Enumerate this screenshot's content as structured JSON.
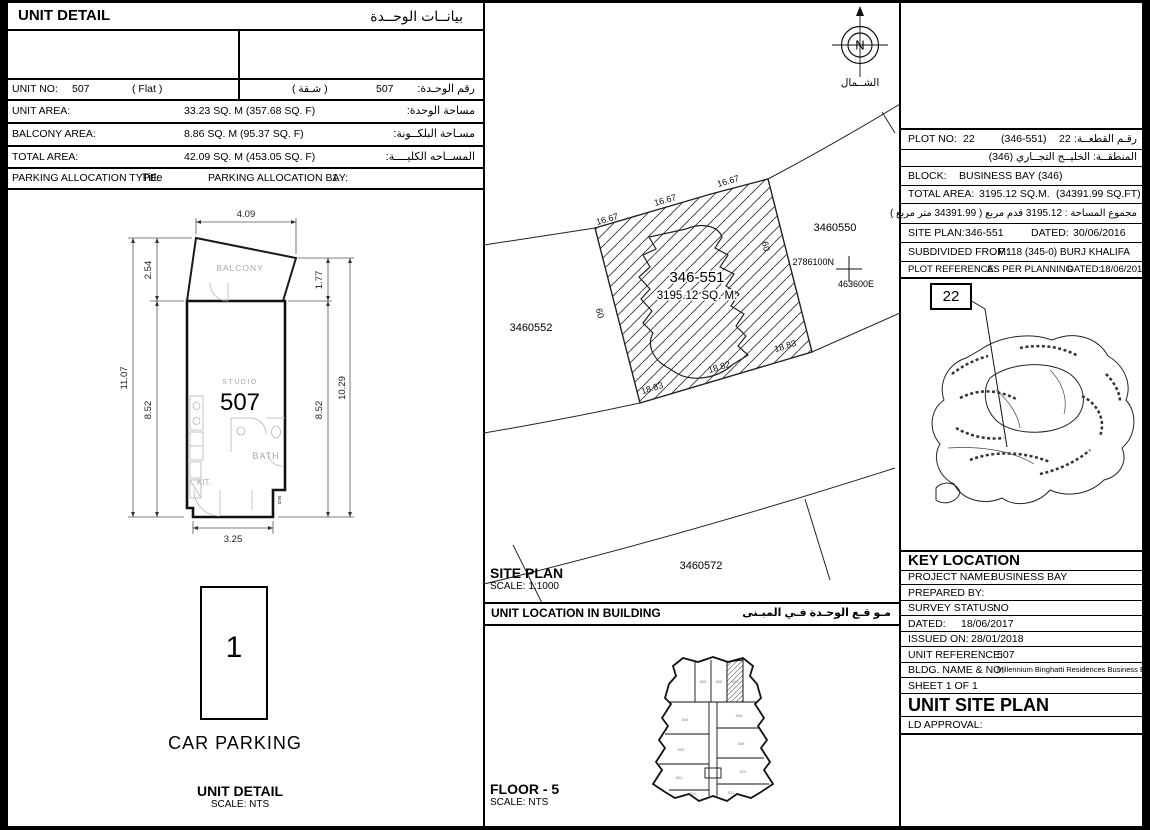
{
  "unit_detail": {
    "title_en": "UNIT DETAIL",
    "title_ar": "بيانــات الوحــدة",
    "unit_no": {
      "label": "UNIT NO:",
      "value": "507",
      "type_en": "(   Flat   )",
      "type_ar": "( شـقة )",
      "value_ar": "507",
      "label_ar": "رقم الوحـدة:"
    },
    "rows": [
      {
        "label": "UNIT AREA:",
        "value": "33.23 SQ. M (357.68 SQ. F)",
        "label_ar": "مساحة الوحدة:"
      },
      {
        "label": "BALCONY AREA:",
        "value": "8.86 SQ. M (95.37 SQ. F)",
        "label_ar": "مسـاحة البلكــونة:"
      },
      {
        "label": "TOTAL AREA:",
        "value": "42.09 SQ. M (453.05 SQ. F)",
        "label_ar": "المســاحه الكليــــة:"
      }
    ],
    "parking": {
      "type_label": "PARKING ALLOCATION TYPE:",
      "type_value": "Title",
      "bay_label": "PARKING ALLOCATION BAY:",
      "bay_value": "1"
    }
  },
  "floor_plan": {
    "dims": {
      "top": "4.09",
      "balcony_left": "2.54",
      "overall_left": "11.07",
      "unit_left": "8.52",
      "balcony_right": "1.77",
      "unit_right": "8.52",
      "overall_right": "10.29",
      "bottom": "3.25"
    },
    "labels": {
      "balcony": "BALCONY",
      "studio": "STUDIO",
      "unit_number": "507",
      "bath": "BATH",
      "kitchen": "KIT.",
      "md": "M.D"
    },
    "caption": "UNIT DETAIL",
    "caption_scale": "SCALE: NTS"
  },
  "car_parking": {
    "bay_number": "1",
    "label": "CAR PARKING"
  },
  "site_plan": {
    "north_letter": "N",
    "north_label_ar": "الشــمال",
    "plot_number": "346-551",
    "plot_area": "3195.12 SQ. M.",
    "dim_top": [
      "16.67",
      "16.67",
      "16.67"
    ],
    "dim_side_left": "60",
    "dim_side_right": "60",
    "dim_bottom": [
      "18.83",
      "18.82",
      "18.83"
    ],
    "parcels": [
      "3460550",
      "3460552",
      "3460572"
    ],
    "northing": "2786100N",
    "easting": "463600E",
    "caption": "SITE PLAN",
    "caption_scale": "SCALE: 1:1000"
  },
  "unit_location": {
    "title_en": "UNIT LOCATION IN BUILDING",
    "title_ar": "مـو قـع الوحـدة  فـي المبـنى",
    "units": {
      "top": [
        "505",
        "506",
        "507"
      ],
      "left": [
        "504",
        "503",
        "502",
        "501"
      ],
      "right": [
        "508",
        "509",
        "510",
        "511"
      ]
    },
    "caption": "FLOOR - 5",
    "caption_scale": "SCALE: NTS"
  },
  "plot_info": {
    "callout": "22",
    "plot_no_label": "PLOT NO:",
    "plot_no": "22",
    "plot_paren": "(346-551)",
    "plot_no_2": "22",
    "plot_label_ar": "رقـم القطعــة:",
    "district_ar": "المنطقــة: الخليــج التجــاري (346)",
    "block_label": "BLOCK:",
    "block": "BUSINESS BAY (346)",
    "total_area_label": "TOTAL AREA:",
    "total_area": "3195.12 SQ.M.",
    "total_area_ft": "(34391.99 SQ.FT)",
    "total_area_ar": "مجموع المساحة :  3195.12 قدم مربع  ( 34391.99 متر مربع )",
    "site_plan_label": "SITE PLAN:",
    "site_plan": "346-551",
    "dated_label": "DATED:",
    "dated": "30/06/2016",
    "subdivided_label": "SUBDIVIDED FROM:",
    "subdivided": "P.118 (345-0) BURJ KHALIFA",
    "plot_ref_label": "PLOT REFERENCE:",
    "plot_ref_value": "AS PER PLANNING",
    "ref_dated_label": "DATED:",
    "ref_dated": "18/06/2017"
  },
  "key_location": {
    "title": "KEY LOCATION",
    "rows": [
      {
        "label": "PROJECT NAME:",
        "value": "BUSINESS BAY"
      },
      {
        "label": "PREPARED BY:",
        "value": ""
      },
      {
        "label": "SURVEY STATUS:",
        "value": "NO"
      },
      {
        "label": "DATED:",
        "value": "18/06/2017"
      },
      {
        "label": "ISSUED ON:",
        "value": "28/01/2018"
      },
      {
        "label": "UNIT REFERENCE:",
        "value": "507"
      },
      {
        "label": "BLDG. NAME & NO:",
        "value": "Millennium Binghatti Residences Business Bay - 1"
      },
      {
        "label": "SHEET 1 OF 1",
        "value": ""
      }
    ],
    "big_title": "UNIT SITE PLAN",
    "ld_label": "LD APPROVAL:"
  }
}
